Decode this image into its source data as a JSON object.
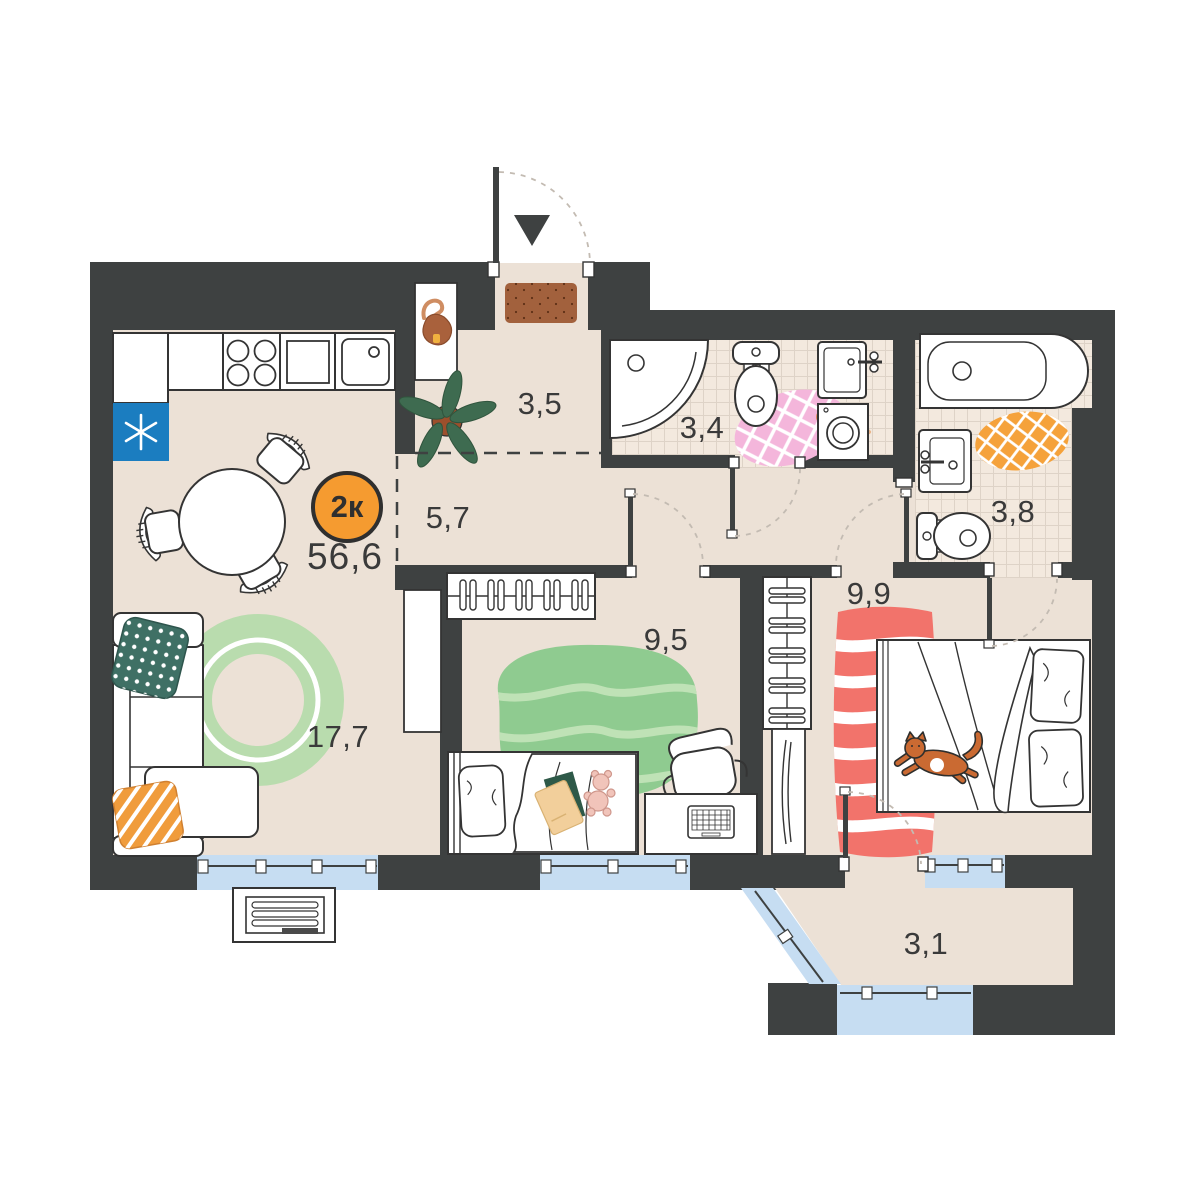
{
  "plan": {
    "type_badge": "2к",
    "total_area": "56,6",
    "rooms": [
      {
        "id": "hallway",
        "area": "3,5"
      },
      {
        "id": "corridor",
        "area": "5,7"
      },
      {
        "id": "bathroom",
        "area": "3,4"
      },
      {
        "id": "ensuite-bathroom",
        "area": "3,8"
      },
      {
        "id": "bedroom",
        "area": "9,9"
      },
      {
        "id": "kids-room",
        "area": "9,5"
      },
      {
        "id": "living-kitchen",
        "area": "17,7"
      },
      {
        "id": "balcony",
        "area": "3,1"
      }
    ],
    "colors": {
      "wall": "#3e4141",
      "floor": "#ece1d6",
      "tile": "#f3e9de",
      "glazing": "#c6ddf2",
      "badge": "#f59b30",
      "fridge": "#1b7dc0",
      "rug_green_living": "#b9dcae",
      "rug_green_kids": "#8fcb90",
      "rug_red": "#f2736b",
      "rug_pink": "#f4b6db",
      "rug_orange": "#f5a23b",
      "doormat": "#a2613d",
      "cat": "#ca6a32"
    },
    "icons": {
      "entrance": "entrance-arrow-icon",
      "fridge": "asterisk-icon"
    }
  }
}
